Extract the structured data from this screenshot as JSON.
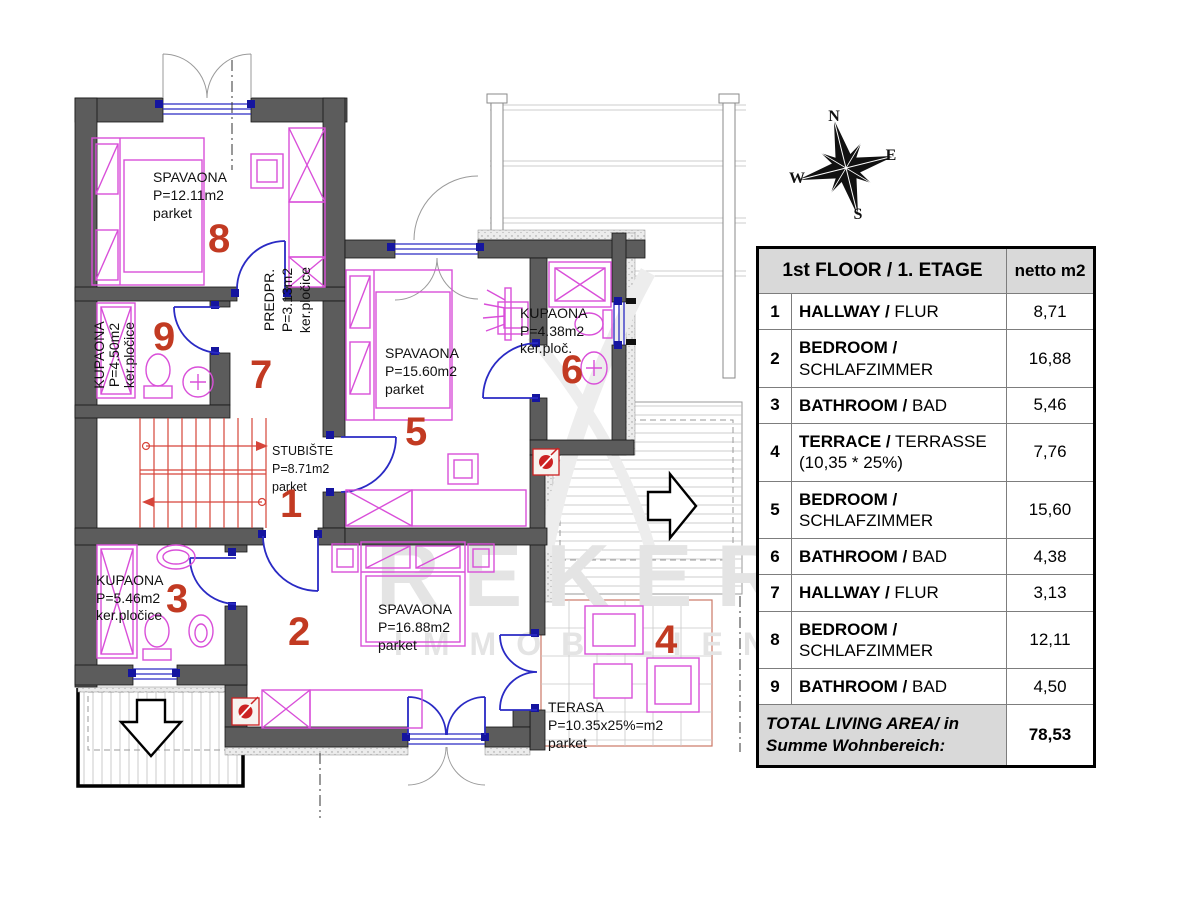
{
  "table": {
    "header": {
      "title": "1st FLOOR / 1. ETAGE",
      "unit": "netto m2"
    },
    "rows": [
      {
        "num": "1",
        "bold": "HALLWAY /",
        "regular": "FLUR",
        "value": "8,71"
      },
      {
        "num": "2",
        "bold": "BEDROOM /",
        "regular": "SCHLAFZIMMER",
        "value": "16,88"
      },
      {
        "num": "3",
        "bold": "BATHROOM /",
        "regular": "BAD",
        "value": "5,46"
      },
      {
        "num": "4",
        "bold": "TERRACE /",
        "regular": "TERRASSE (10,35 * 25%)",
        "value": "7,76"
      },
      {
        "num": "5",
        "bold": "BEDROOM /",
        "regular": "SCHLAFZIMMER",
        "value": "15,60"
      },
      {
        "num": "6",
        "bold": "BATHROOM /",
        "regular": "BAD",
        "value": "4,38"
      },
      {
        "num": "7",
        "bold": "HALLWAY /",
        "regular": "FLUR",
        "value": "3,13"
      },
      {
        "num": "8",
        "bold": "BEDROOM /",
        "regular": "SCHLAFZIMMER",
        "value": "12,11"
      },
      {
        "num": "9",
        "bold": "BATHROOM /",
        "regular": "BAD",
        "value": "4,50"
      }
    ],
    "total": {
      "label": "TOTAL LIVING AREA/ in Summe Wohnbereich:",
      "value": "78,53"
    }
  },
  "plan": {
    "rooms": {
      "r1": {
        "number": "1",
        "line1": "STUBIŠTE",
        "line2": "P=8.71m2",
        "line3": "parket"
      },
      "r2": {
        "number": "2",
        "line1": "SPAVAONA",
        "line2": "P=16.88m2",
        "line3": "parket"
      },
      "r3": {
        "number": "3",
        "line1": "KUPAONA",
        "line2": "P=5.46m2",
        "line3": "ker.pločice"
      },
      "r4": {
        "number": "4",
        "line1": "TERASA",
        "line2": "P=10.35x25%=m2",
        "line3": "parket"
      },
      "r5": {
        "number": "5",
        "line1": "SPAVAONA",
        "line2": "P=15.60m2",
        "line3": "parket"
      },
      "r6": {
        "number": "6",
        "line1": "KUPAONA",
        "line2": "P=4.38m2",
        "line3": "ker.ploč."
      },
      "r7": {
        "number": "7",
        "line1": "PREDPR.",
        "line2": "P=3.13m2",
        "line3": "ker.pločice"
      },
      "r8": {
        "number": "8",
        "line1": "SPAVAONA",
        "line2": "P=12.11m2",
        "line3": "parket"
      },
      "r9": {
        "number": "9",
        "line1": "KUPAONA",
        "line2": "P=4.50m2",
        "line3": "ker.pločice"
      }
    },
    "compass": {
      "n": "N",
      "e": "E",
      "s": "S",
      "w": "W"
    },
    "watermark": {
      "line1": "REKER",
      "line2": "IMMOBILIEN"
    }
  },
  "colors": {
    "wall": "#5c5c5c",
    "furniture": "#d94fd9",
    "door_window": "#2a2ac4",
    "room_number": "#c23a22",
    "stairs": "#d6453a",
    "table_header_bg": "#d9d9d9"
  }
}
